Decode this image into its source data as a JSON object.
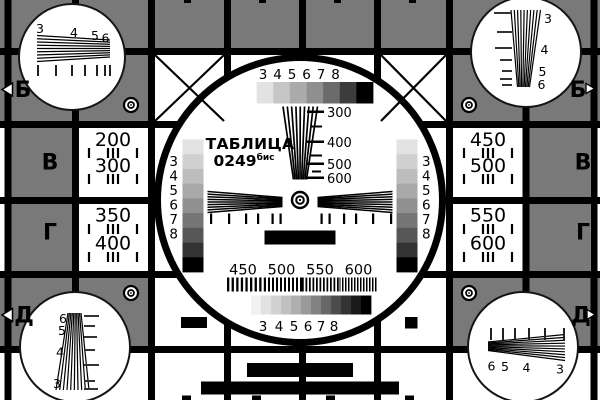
{
  "card": {
    "title": "ТАБЛИЦА",
    "number": "0249",
    "number_suffix": "бис"
  },
  "colors": {
    "background_gray": "#797979",
    "line_black": "#000000",
    "cell_white": "#ffffff"
  },
  "edge_markers": {
    "row_b": "Б",
    "row_v": "В",
    "row_g": "Г",
    "row_d": "Д"
  },
  "left_panel": {
    "values": [
      "200",
      "300",
      "350",
      "400"
    ]
  },
  "right_panel": {
    "values": [
      "450",
      "500",
      "550",
      "600"
    ]
  },
  "center_circle": {
    "top_scale": {
      "labels": [
        "3",
        "4",
        "5",
        "6",
        "7",
        "8"
      ],
      "steps": [
        "#ffffff",
        "#e2e2e2",
        "#c6c6c6",
        "#ababab",
        "#8f8f8f",
        "#6b6b6b",
        "#3c3c3c",
        "#000000"
      ]
    },
    "side_stair": {
      "labels": [
        "3",
        "4",
        "5",
        "6",
        "7",
        "8"
      ],
      "steps": [
        "#e3e3e3",
        "#d0d0d0",
        "#bdbdbd",
        "#a8a8a8",
        "#909090",
        "#757575",
        "#575757",
        "#333333",
        "#000000"
      ]
    },
    "bottom_scale": {
      "labels": [
        "3",
        "4",
        "5",
        "6",
        "7",
        "8"
      ],
      "steps": [
        "#ffffff",
        "#f1f1f1",
        "#e2e2e2",
        "#d2d2d2",
        "#c1c1c1",
        "#afafaf",
        "#9a9a9a",
        "#828282",
        "#676767",
        "#4c4c4c",
        "#333333",
        "#1a1a1a",
        "#000000"
      ]
    },
    "resolution_scale": {
      "labels": [
        "300",
        "400",
        "500",
        "600"
      ]
    },
    "frequency_scale": {
      "labels": [
        "450",
        "500",
        "550",
        "600"
      ]
    }
  },
  "corner_circles": {
    "top_left": {
      "labels": [
        "3",
        "4",
        "5",
        "6"
      ]
    },
    "top_right": {
      "labels": [
        "3",
        "4",
        "5",
        "6"
      ]
    },
    "bottom_left": {
      "labels": [
        "6",
        "5",
        "4",
        "3"
      ]
    },
    "bottom_right": {
      "labels": [
        "6",
        "5",
        "4",
        "3"
      ]
    }
  }
}
